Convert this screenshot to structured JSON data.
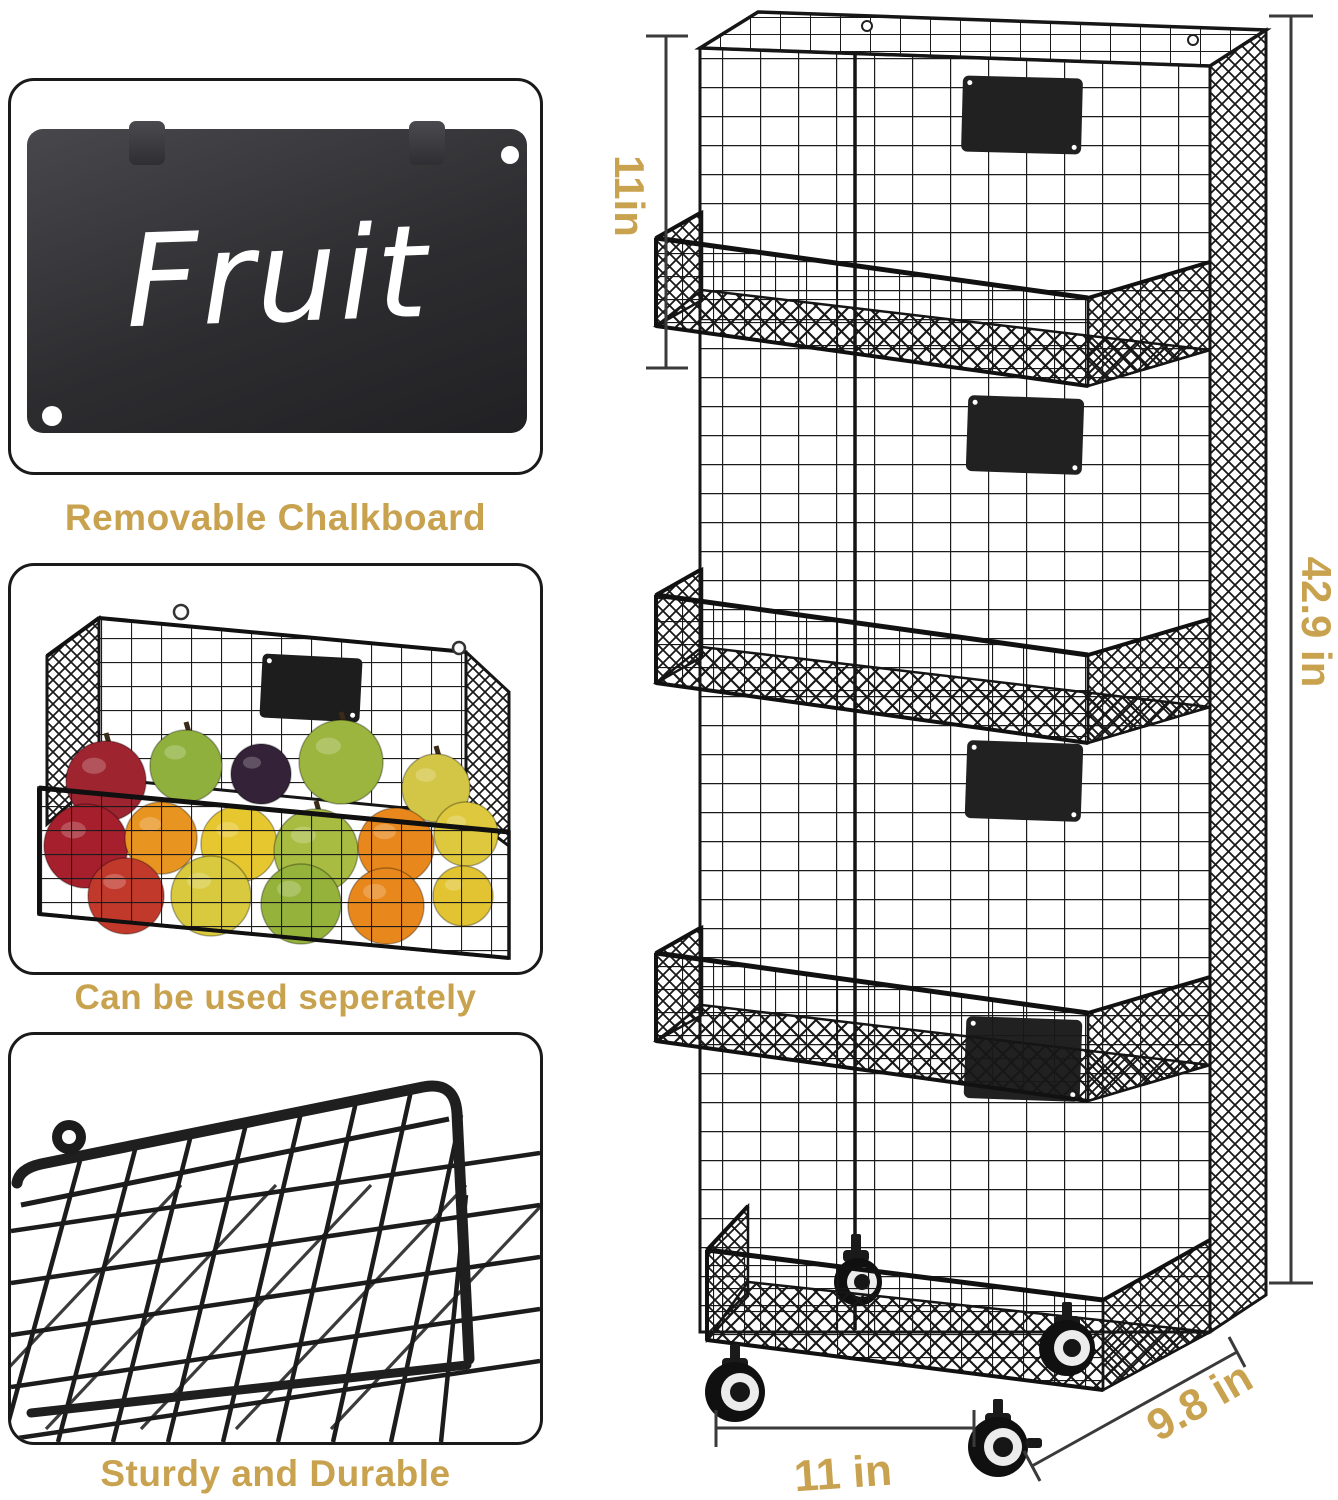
{
  "colors": {
    "accent_gold": "#C8A24E",
    "wire_black": "#1b1b1b",
    "label_plate": "#212121",
    "chalkboard_dark": "#2d2d30",
    "background": "#ffffff"
  },
  "left_column": {
    "panels": [
      {
        "caption": "Removable Chalkboard",
        "board_text": "Fruit"
      },
      {
        "caption": "Can be used seperately"
      },
      {
        "caption": "Sturdy and Durable"
      }
    ]
  },
  "rack": {
    "tiers": 4,
    "dimensions": {
      "tier_height": "11in",
      "total_height": "42.9 in",
      "base_width": "11 in",
      "base_depth": "9.8 in"
    }
  },
  "fruit_basket": {
    "fruits": [
      {
        "type": "red-apple",
        "cx": 95,
        "cy": 215,
        "r": 40,
        "color": "#9e2430",
        "stem": true
      },
      {
        "type": "green-apple",
        "cx": 175,
        "cy": 200,
        "r": 36,
        "color": "#8fb03c",
        "stem": true
      },
      {
        "type": "plum",
        "cx": 250,
        "cy": 208,
        "r": 30,
        "color": "#342238",
        "stem": false
      },
      {
        "type": "green-apple",
        "cx": 330,
        "cy": 196,
        "r": 42,
        "color": "#9cb53e",
        "stem": true
      },
      {
        "type": "yellow-pear",
        "cx": 425,
        "cy": 222,
        "r": 34,
        "color": "#d3c545",
        "stem": true
      },
      {
        "type": "red-apple",
        "cx": 75,
        "cy": 280,
        "r": 42,
        "color": "#a51f2c",
        "stem": false
      },
      {
        "type": "orange",
        "cx": 150,
        "cy": 272,
        "r": 36,
        "color": "#e89420",
        "stem": false
      },
      {
        "type": "lemon",
        "cx": 228,
        "cy": 278,
        "r": 38,
        "color": "#e6c72f",
        "stem": false
      },
      {
        "type": "green-pear",
        "cx": 305,
        "cy": 285,
        "r": 42,
        "color": "#a8bc42",
        "stem": true
      },
      {
        "type": "orange",
        "cx": 385,
        "cy": 280,
        "r": 38,
        "color": "#e8881c",
        "stem": false
      },
      {
        "type": "lemon",
        "cx": 455,
        "cy": 268,
        "r": 32,
        "color": "#dec83e",
        "stem": false
      },
      {
        "type": "red-apple",
        "cx": 115,
        "cy": 330,
        "r": 38,
        "color": "#c0392b",
        "stem": false
      },
      {
        "type": "yellow-pear",
        "cx": 200,
        "cy": 330,
        "r": 40,
        "color": "#d8c93f",
        "stem": false
      },
      {
        "type": "green-pear",
        "cx": 290,
        "cy": 338,
        "r": 40,
        "color": "#95b23b",
        "stem": false
      },
      {
        "type": "orange",
        "cx": 375,
        "cy": 340,
        "r": 38,
        "color": "#e8871c",
        "stem": false
      },
      {
        "type": "lemon",
        "cx": 452,
        "cy": 330,
        "r": 30,
        "color": "#e2c433",
        "stem": false
      }
    ]
  }
}
